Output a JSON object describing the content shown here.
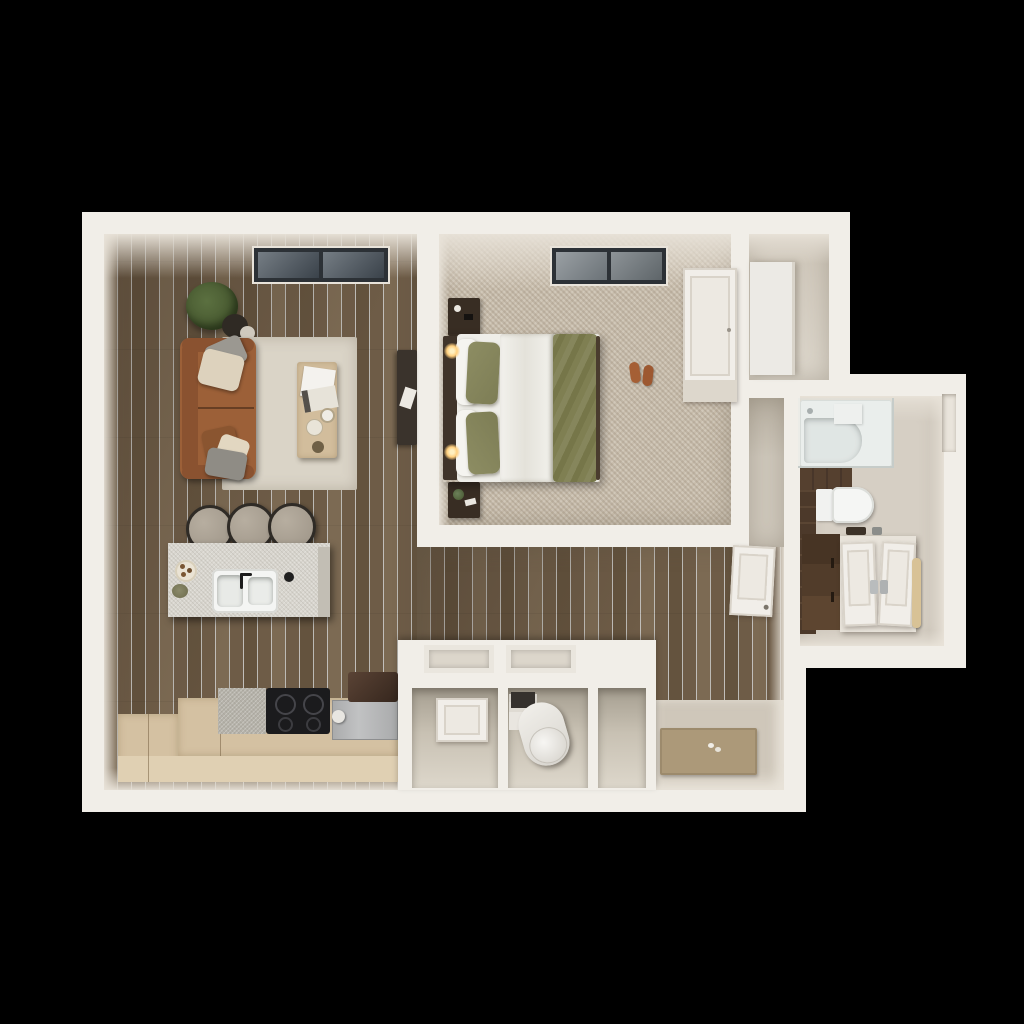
{
  "scene": {
    "kind": "3d-rendered-floor-plan",
    "description": "Top-down 3D render of a one-bedroom apartment on a black background",
    "rooms": [
      {
        "name": "living-room",
        "floor": "dark wood planks",
        "contents": [
          "skylight",
          "potted-plant",
          "leather-sofa",
          "throw-pillows",
          "area-rug",
          "coffee-table",
          "media-console"
        ]
      },
      {
        "name": "kitchen",
        "floor": "dark wood planks",
        "contents": [
          "island-with-sink",
          "bar-stools",
          "l-shaped-counter",
          "cooktop",
          "oven",
          "cookie-plate"
        ]
      },
      {
        "name": "bedroom",
        "floor": "speckled carpet",
        "contents": [
          "skylight",
          "bed-with-olive-bedding",
          "headboard",
          "nightstands",
          "wall-sconces",
          "slippers",
          "wardrobe"
        ]
      },
      {
        "name": "closet-nook",
        "floor": "beige",
        "contents": [
          "storage-column"
        ]
      },
      {
        "name": "bathroom",
        "floor": "beige tile",
        "contents": [
          "bathtub",
          "shower-glass",
          "toilet",
          "wood-vanity",
          "towel",
          "window-niche",
          "dark-wood-accent-wall"
        ]
      },
      {
        "name": "hallway-entry",
        "floor": "dark wood planks",
        "contents": [
          "utility-closet-block",
          "water-heater",
          "closet-door-panel",
          "bathroom-door-panel",
          "entry-mat"
        ]
      }
    ]
  },
  "colors": {
    "bg": "#000000",
    "wall": "#f1eee8",
    "wood_a": "#7c6a53",
    "wood_b": "#6e5c47",
    "wood_c": "#64533e",
    "carpet": "#c8bdac",
    "bath_floor": "#d6cfc4",
    "soft_floor": "#d0c9bd",
    "entry_floor": "#cfc7ba",
    "mat": "#ac9979",
    "island_top": "#d8d5ce",
    "counter_wood": "#d4c1a2",
    "counter_face": "#e0d0b3",
    "stone": "#b4b1a8",
    "cooktop": "#1b1b1d",
    "steel": "#b5b6b7",
    "appliance_dark": "#46332a",
    "sofa": "#9c6038",
    "sofa_dark": "#8a5230",
    "rug": "#dad4c7",
    "table": "#d2bd9c",
    "bed_white": "#efeee9",
    "olive": "#7d7d55",
    "olive_light": "#8d8d63",
    "headboard": "#40342a",
    "nightstand": "#382d23",
    "accent_wood": "#4c392a",
    "vanity_wood": "#5d4530",
    "towel": "#d8c296",
    "porcelain": "#f4f5f3",
    "glass_frame": "#2c3136",
    "glass_a": "#757d84",
    "glass_b": "#3a424a",
    "plant": "#5b7040",
    "plant_dark": "#46572f",
    "heater": "#ece9e4",
    "white_panel": "#f1eee9",
    "panel_line": "#d9d3c9",
    "lamp": "#ffcf7e"
  }
}
